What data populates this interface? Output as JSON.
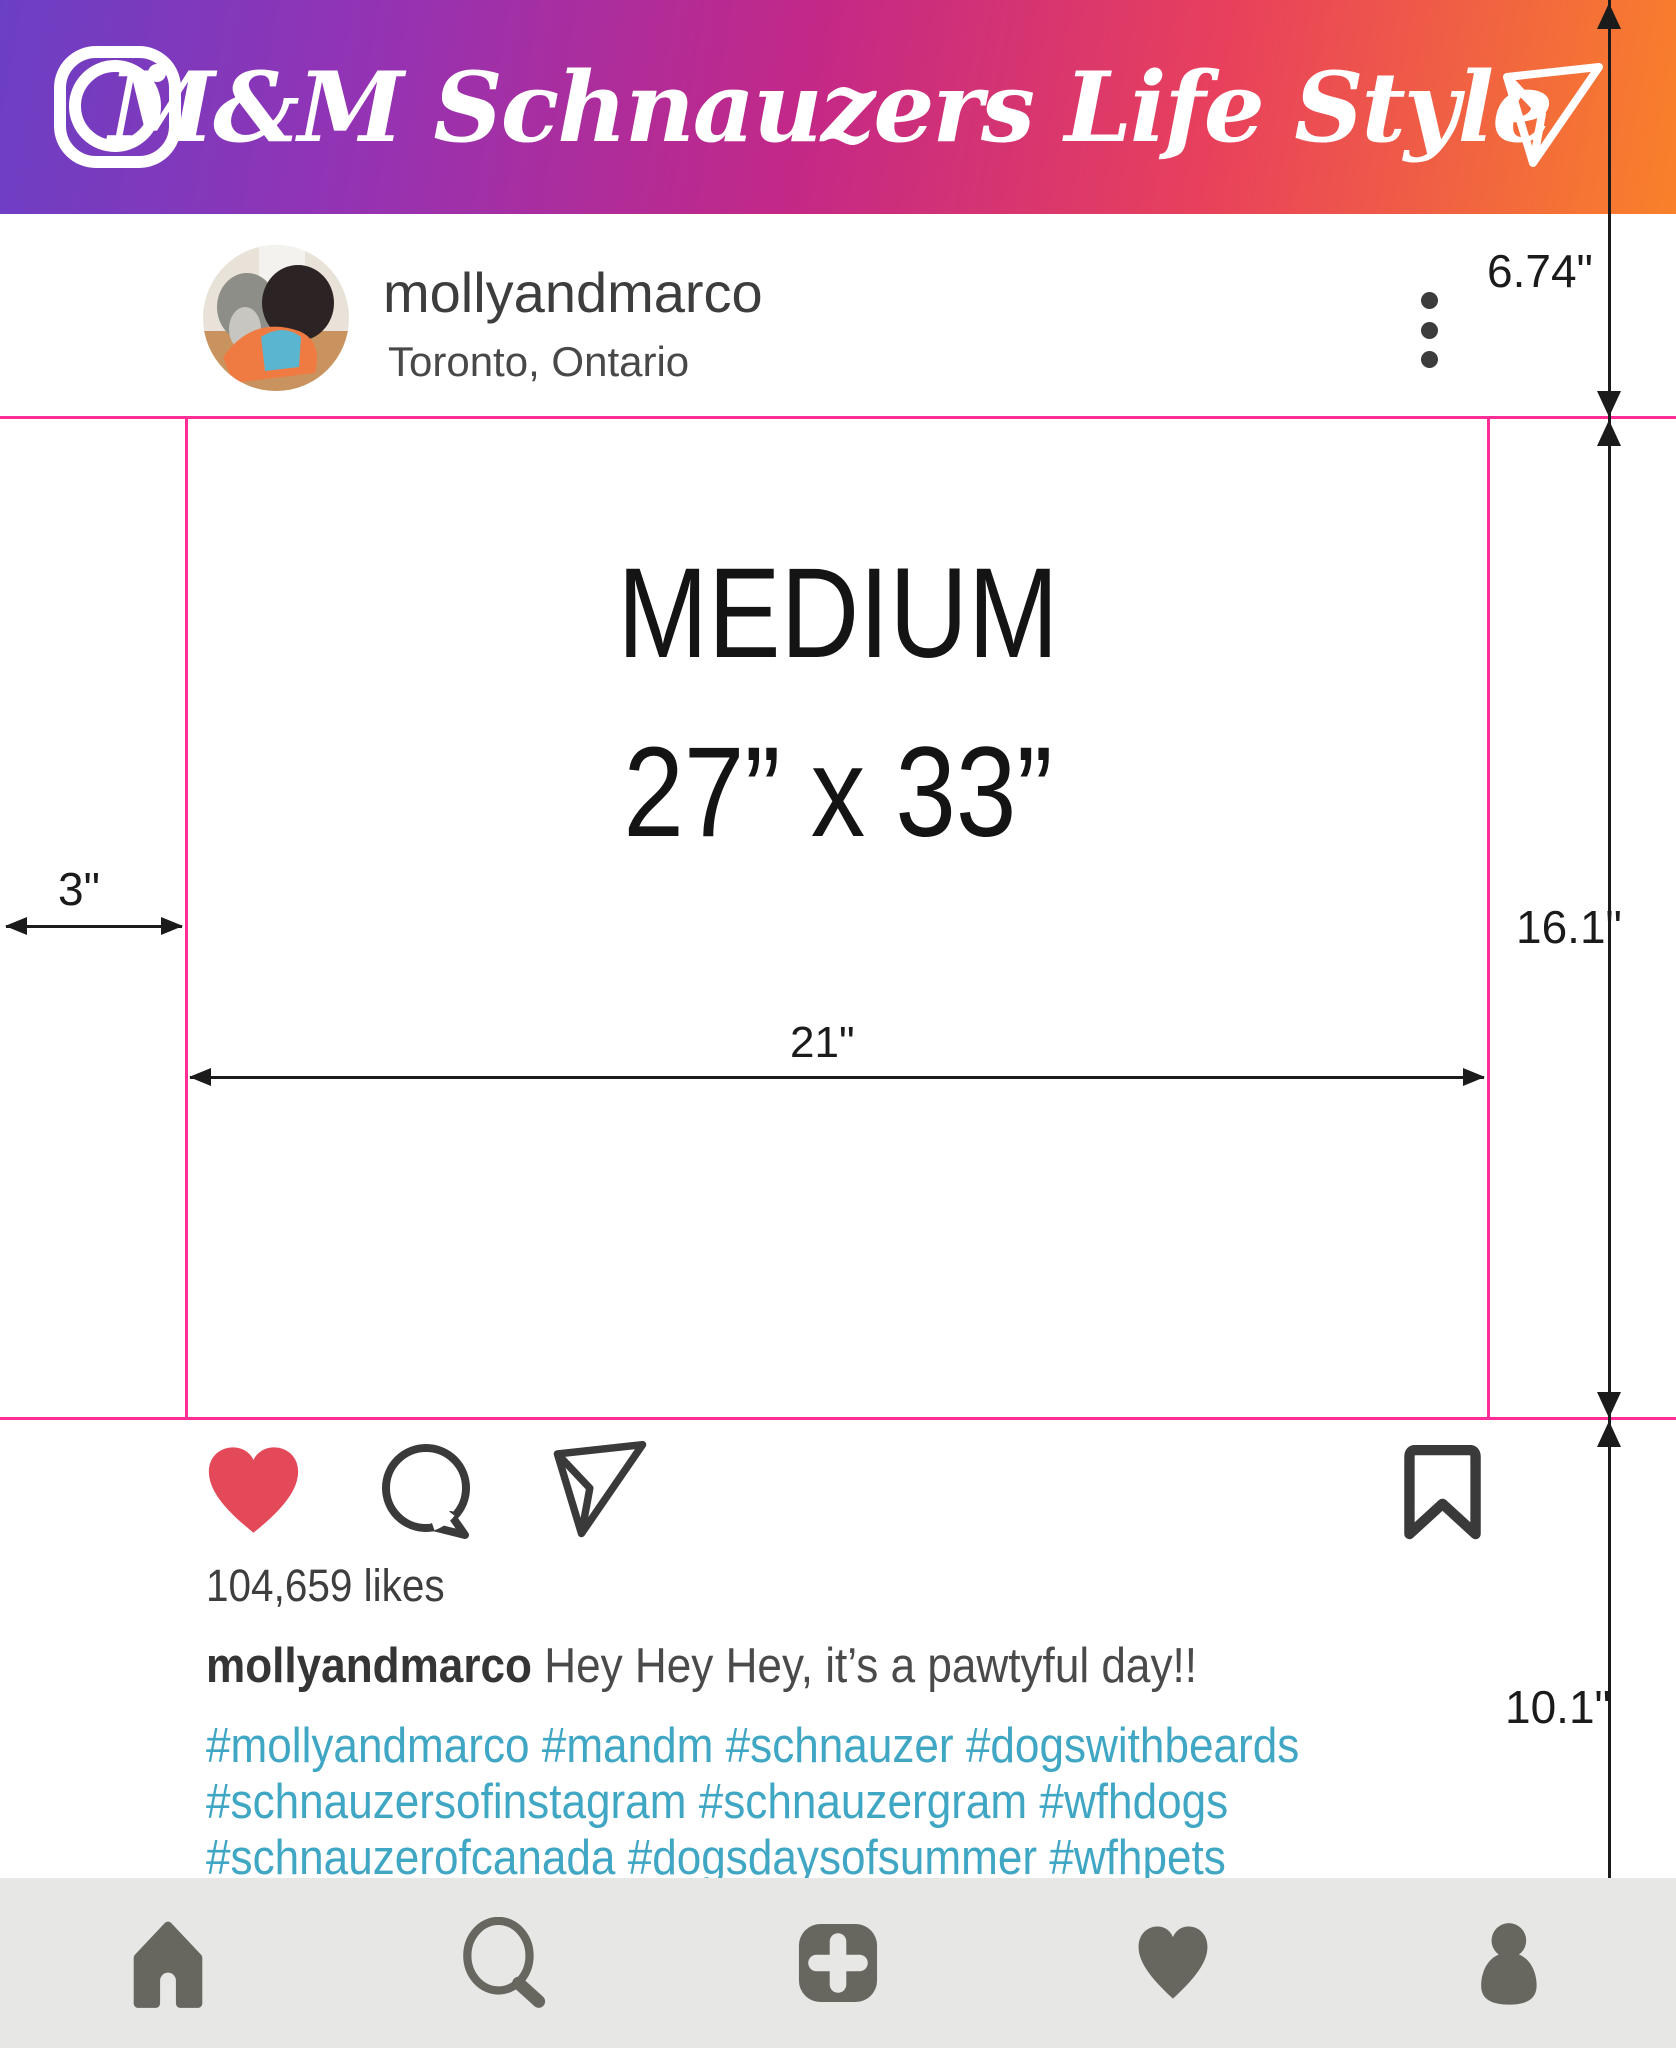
{
  "header": {
    "title": "M&M Schnauzers Life Style",
    "camera_icon": "instagram-camera",
    "share_icon": "paper-plane",
    "gradient": [
      "#6b3fc4",
      "#c32887",
      "#f9812a"
    ]
  },
  "post": {
    "username": "mollyandmarco",
    "location": "Toronto, Ontario",
    "menu_icon": "kebab-menu",
    "likes": "104,659 likes",
    "caption_username": "mollyandmarco",
    "caption_text": "Hey Hey Hey, it’s a pawtyful day!!",
    "hashtag_lines": [
      "#mollyandmarco #mandm #schnauzer #dogswithbeards",
      "#schnauzersofinstagram #schnauzergram #wfhdogs",
      "#schnauzerofcanada #dogsdaysofsummer #wfhpets"
    ],
    "action_icons": [
      "like-heart",
      "comment-bubble",
      "share-plane",
      "bookmark"
    ],
    "like_color": "#e4495a",
    "icon_color": "#3a3a3a",
    "hashtag_color": "#3fa6c4"
  },
  "size_diagram": {
    "size_name": "MEDIUM",
    "size_dims": "27” x 33”",
    "left_margin": "3\"",
    "image_width": "21\"",
    "top_height": "6.74\"",
    "image_height": "16.1\"",
    "bottom_height": "10.1\"",
    "guide_color": "#ff2d96",
    "dim_color": "#1b1b1b"
  },
  "nav": {
    "items": [
      "home",
      "search",
      "new-post",
      "activity",
      "profile"
    ],
    "bar_color": "#e7e7e6",
    "icon_color": "#67665f"
  }
}
